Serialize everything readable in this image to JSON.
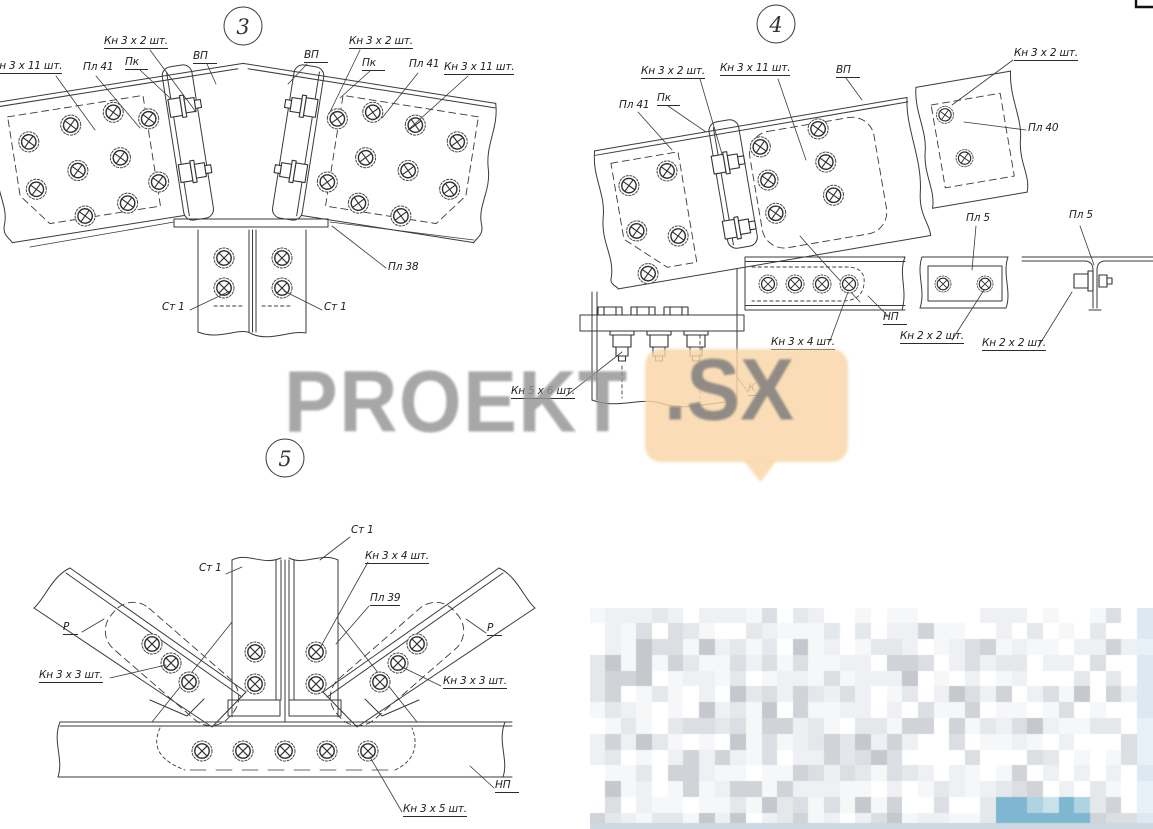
{
  "page": {
    "background": "#ffffff",
    "kind": "structural steel connection details drawing"
  },
  "markers": {
    "d3": "3",
    "d4": "4",
    "d5": "5"
  },
  "callouts": {
    "d3_kn3x11_left": "Кн 3 х 11 шт.",
    "d3_pl41_left": "Пл 41",
    "d3_pk_left": "Пк",
    "d3_kn3x2_left": "Кн 3 х 2 шт.",
    "d3_vp_left": "ВП",
    "d3_vp_right": "ВП",
    "d3_kn3x2_right": "Кн 3 х 2 шт.",
    "d3_pk_right": "Пк",
    "d3_pl41_right": "Пл 41",
    "d3_kn3x11_right": "Кн 3 х 11 шт.",
    "d3_pl38": "Пл 38",
    "d3_st1_left": "Ст 1",
    "d3_st1_right": "Ст 1",
    "d4_pl41": "Пл 41",
    "d4_pk": "Пк",
    "d4_kn3x2_left": "Кн 3 х 2 шт.",
    "d4_kn3x11": "Кн 3 х 11 шт.",
    "d4_vp": "ВП",
    "d4_kn3x2_right": "Кн 3 х 2 шт.",
    "d4_pl40": "Пл 40",
    "d4_pl5_plate": "Пл 5",
    "d4_pl5_tee": "Пл 5",
    "d4_np": "НП",
    "d4_kn3x4": "Кн 3 х 4 шт.",
    "d4_kn2x2_plate": "Кн 2 х 2 шт.",
    "d4_kn2x2_tee": "Кн 2 х 2 шт.",
    "d4_kn5x6": "Кн 5 х 6 шт.",
    "d4_k": "К",
    "d5_st1_left": "Ст 1",
    "d5_st1_right": "Ст 1",
    "d5_kn3x4": "Кн 3 х 4 шт.",
    "d5_pl39": "Пл 39",
    "d5_r_left": "Р",
    "d5_r_right": "Р",
    "d5_kn3x3_left": "Кн 3 х 3 шт.",
    "d5_kn3x3_right": "Кн 3 х 3 шт.",
    "d5_np": "НП",
    "d5_kn3x5": "Кн 3 х 5 шт."
  },
  "watermark": {
    "brand": "PROEKT",
    "suffix": ".SX",
    "text_color": "#949494",
    "bubble_color": "#f9d6a6"
  },
  "censored_block": {
    "note": "pixelated censored title block",
    "x": 590,
    "y": 608,
    "width": 563,
    "height": 221,
    "cols": 36,
    "rows": 14,
    "seed": 11,
    "palette": [
      "#ffffff",
      "#f6f7f8",
      "#eef0f3",
      "#e5e8eb",
      "#dbdee2",
      "#d0d4d8",
      "#c5c9ce"
    ],
    "teal": [
      "#7fb7d1",
      "#93c4da",
      "#b0d3e2",
      "#cae0ea"
    ],
    "strip_color": "#ccd9e3"
  }
}
